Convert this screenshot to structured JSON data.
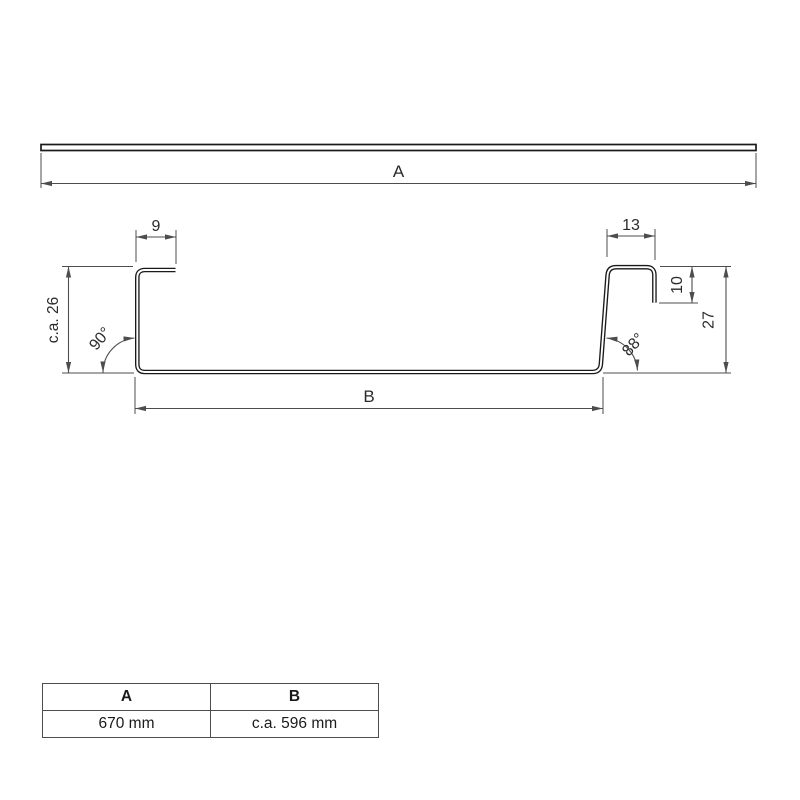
{
  "flat_sheet": {
    "dim_label": "A"
  },
  "profile": {
    "dims": {
      "lip_left": "9",
      "lip_right": "13",
      "height_left": "c.a. 26",
      "angle_left": "90°",
      "angle_right": "88°",
      "lip_drop_right": "10",
      "height_right": "27",
      "base": "B"
    }
  },
  "table": {
    "headers": [
      "A",
      "B"
    ],
    "values": [
      "670 mm",
      "c.a. 596 mm"
    ]
  },
  "colors": {
    "profile": "#1a1a1a",
    "dimension": "#4d4d4d",
    "text": "#2b2b2b",
    "background": "#ffffff"
  }
}
